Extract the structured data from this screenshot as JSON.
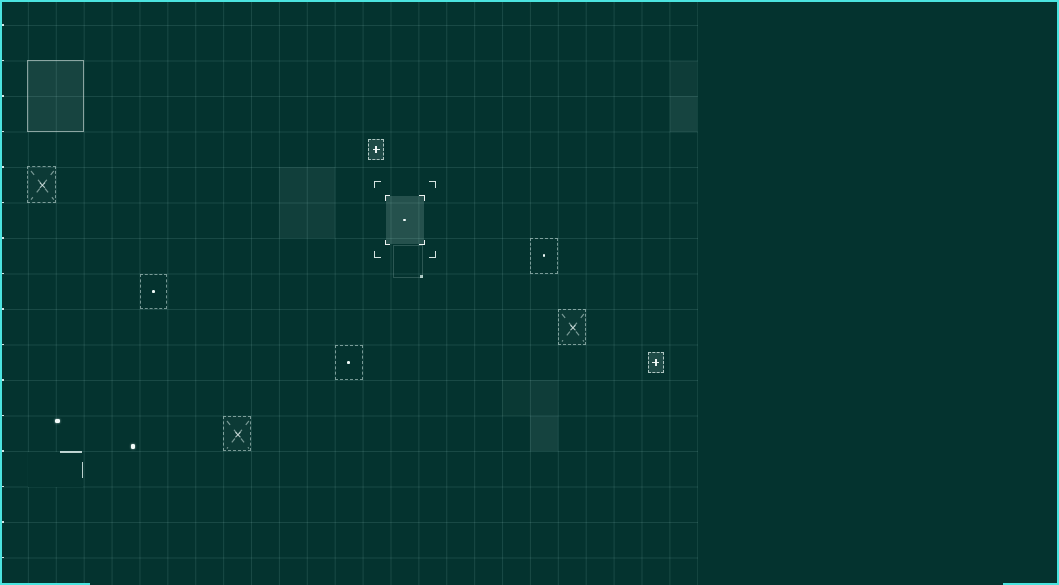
{
  "canvas": {
    "width": 1059,
    "height": 585,
    "bg_color": "#04332f",
    "grid_line_color": "rgba(170,225,218,0.13)",
    "frame_color": "#4be4e0",
    "marker_stroke_color": "rgba(228,248,244,0.5)",
    "marker_bright_color": "#f2fbf9"
  },
  "grid": {
    "x0": 0,
    "y0": 25,
    "col_w": 27.9,
    "row_h": 35.5,
    "cols": 25,
    "rows": 16,
    "board_width": 698,
    "board_height": 585,
    "left_row_ticks": true
  },
  "frame_segments": [
    {
      "name": "frame-top",
      "x": 0,
      "y": 0,
      "w": 1059,
      "h": 2.3
    },
    {
      "name": "frame-left",
      "x": 0,
      "y": 0,
      "w": 2,
      "h": 585
    },
    {
      "name": "frame-right",
      "x": 1056.8,
      "y": 0,
      "w": 2.2,
      "h": 585
    },
    {
      "name": "frame-bottom-left",
      "x": 0,
      "y": 582.6,
      "w": 90,
      "h": 2.4
    },
    {
      "name": "frame-bottom-right",
      "x": 1003,
      "y": 582.6,
      "w": 56,
      "h": 2.4
    }
  ],
  "markers": [
    {
      "name": "outlined-region",
      "type": "region",
      "x": 26.5,
      "y": 60,
      "w": 57,
      "h": 71.5
    },
    {
      "name": "cross-cell-1",
      "type": "cross",
      "x": 26.8,
      "y": 166.3,
      "w": 28.8,
      "h": 36.6
    },
    {
      "name": "lit-block-1",
      "type": "light",
      "x": 279,
      "y": 167.2,
      "w": 55.8,
      "h": 70.8,
      "alpha": 0.065
    },
    {
      "name": "lit-cell-topright-1",
      "type": "light",
      "x": 669.6,
      "y": 60.5,
      "w": 27.9,
      "h": 35.5,
      "alpha": 0.05
    },
    {
      "name": "lit-cell-topright-2",
      "type": "light",
      "x": 669.6,
      "y": 96,
      "w": 27.9,
      "h": 35.5,
      "alpha": 0.09
    },
    {
      "name": "plus-chip-1",
      "type": "plus",
      "x": 367.8,
      "y": 139.3,
      "w": 16.6,
      "h": 20.8
    },
    {
      "name": "target-cursor",
      "type": "target",
      "x": 374,
      "y": 180.5,
      "w": 61.5,
      "h": 77.5
    },
    {
      "name": "dot-cell-1",
      "type": "dotcell",
      "x": 530.1,
      "y": 238,
      "w": 27.9,
      "h": 35.5
    },
    {
      "name": "dot-cell-2",
      "type": "dotcell",
      "x": 139.5,
      "y": 273.5,
      "w": 27.9,
      "h": 35.5
    },
    {
      "name": "cross-cell-2",
      "type": "cross",
      "x": 558,
      "y": 309,
      "w": 27.9,
      "h": 35.5
    },
    {
      "name": "dot-cell-3",
      "type": "dotcell",
      "x": 334.8,
      "y": 344.5,
      "w": 27.9,
      "h": 35.5
    },
    {
      "name": "plus-chip-2",
      "type": "plus",
      "x": 647.6,
      "y": 352.4,
      "w": 16.6,
      "h": 20.8
    },
    {
      "name": "lit-cell-mid-1",
      "type": "light",
      "x": 502.2,
      "y": 380,
      "w": 27.9,
      "h": 35.5,
      "alpha": 0.03
    },
    {
      "name": "lit-cell-mid-2",
      "type": "light",
      "x": 530.1,
      "y": 380,
      "w": 27.9,
      "h": 35.5,
      "alpha": 0.055
    },
    {
      "name": "lit-cell-mid-3",
      "type": "light",
      "x": 530.1,
      "y": 415.5,
      "w": 27.9,
      "h": 35.5,
      "alpha": 0.085
    },
    {
      "name": "cross-cell-3",
      "type": "cross",
      "x": 223.2,
      "y": 415.5,
      "w": 27.9,
      "h": 35.5
    },
    {
      "name": "unit-dot-1",
      "type": "dot",
      "x": 55.3,
      "y": 418.6,
      "w": 4.6,
      "h": 4.6
    },
    {
      "name": "unit-dot-2",
      "type": "dot",
      "x": 130.6,
      "y": 444.4,
      "w": 4.6,
      "h": 4.6
    },
    {
      "name": "cleared-patch",
      "type": "hole",
      "x": 28.4,
      "y": 452,
      "w": 55,
      "h": 35
    },
    {
      "name": "cleared-edge-top",
      "type": "seg",
      "x": 59.5,
      "y": 451.2,
      "w": 22.5,
      "h": 1.7
    },
    {
      "name": "cleared-edge-right",
      "type": "seg",
      "x": 81.6,
      "y": 461.5,
      "w": 1.7,
      "h": 16.5
    }
  ]
}
